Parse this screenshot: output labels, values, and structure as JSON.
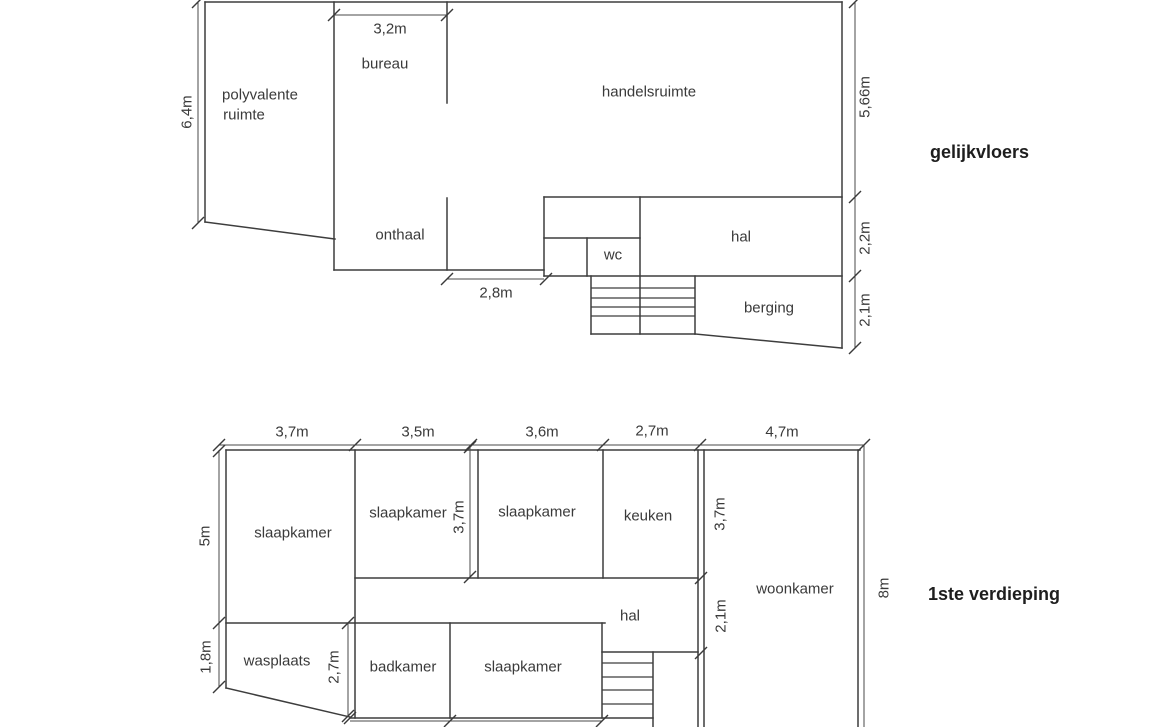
{
  "document": {
    "background": "#ffffff",
    "wall_color": "#3d3d3d",
    "dimension_color": "#4a4a4a",
    "label_color": "#3a3a3a",
    "title_color": "#1e1e1e"
  },
  "plans": [
    {
      "id": "gelijkvloers",
      "title": {
        "text": "gelijkvloers"
      },
      "walls": [
        [
          205,
          2,
          842,
          2
        ],
        [
          205,
          2,
          205,
          222
        ],
        [
          205,
          222,
          335,
          239
        ],
        [
          334,
          2,
          334,
          270
        ],
        [
          334,
          270,
          544,
          270
        ],
        [
          447,
          2,
          447,
          103
        ],
        [
          447,
          198,
          447,
          270
        ],
        [
          842,
          2,
          842,
          348
        ],
        [
          544,
          197,
          842,
          197
        ],
        [
          544,
          197,
          544,
          276
        ],
        [
          544,
          238,
          640,
          238
        ],
        [
          587,
          238,
          587,
          276
        ],
        [
          640,
          197,
          640,
          334
        ],
        [
          544,
          276,
          842,
          276
        ],
        [
          591,
          276,
          591,
          334
        ],
        [
          591,
          334,
          695,
          334
        ],
        [
          695,
          276,
          695,
          334
        ],
        [
          695,
          334,
          842,
          348
        ]
      ],
      "stair_treads": [
        [
          591,
          288,
          695,
          288
        ],
        [
          591,
          298,
          695,
          298
        ],
        [
          591,
          307,
          695,
          307
        ],
        [
          591,
          316,
          695,
          316
        ]
      ],
      "dim_lines": [
        [
          198,
          2,
          198,
          223
        ],
        [
          334,
          15,
          447,
          15
        ],
        [
          447,
          279,
          544,
          279
        ],
        [
          855,
          2,
          855,
          348
        ]
      ],
      "ticks": [
        [
          198,
          2
        ],
        [
          198,
          223
        ],
        [
          334,
          15
        ],
        [
          447,
          15
        ],
        [
          447,
          279
        ],
        [
          546,
          279
        ],
        [
          855,
          2
        ],
        [
          855,
          197
        ],
        [
          855,
          276
        ],
        [
          855,
          348
        ]
      ],
      "dim_labels": [
        {
          "text": "6,4m",
          "x": 187,
          "y": 112,
          "rotated": true
        },
        {
          "text": "3,2m",
          "x": 390,
          "y": 29,
          "rotated": false
        },
        {
          "text": "2,8m",
          "x": 496,
          "y": 293,
          "rotated": false
        },
        {
          "text": "5,66m",
          "x": 865,
          "y": 97,
          "rotated": true
        },
        {
          "text": "2,2m",
          "x": 865,
          "y": 238,
          "rotated": true
        },
        {
          "text": "2,1m",
          "x": 865,
          "y": 310,
          "rotated": true
        }
      ],
      "room_labels": [
        {
          "text": "polyvalente",
          "x": 260,
          "y": 95
        },
        {
          "text": "ruimte",
          "x": 244,
          "y": 115
        },
        {
          "text": "bureau",
          "x": 385,
          "y": 64
        },
        {
          "text": "handelsruimte",
          "x": 649,
          "y": 92
        },
        {
          "text": "onthaal",
          "x": 400,
          "y": 235
        },
        {
          "text": "wc",
          "x": 613,
          "y": 255
        },
        {
          "text": "hal",
          "x": 741,
          "y": 237
        },
        {
          "text": "berging",
          "x": 769,
          "y": 308
        }
      ]
    },
    {
      "id": "eerste-verdieping",
      "title": {
        "text": "1ste verdieping"
      },
      "walls": [
        [
          226,
          450,
          860,
          450
        ],
        [
          226,
          450,
          226,
          688
        ],
        [
          226,
          688,
          350,
          717
        ],
        [
          350,
          718,
          653,
          718
        ],
        [
          355,
          450,
          355,
          718
        ],
        [
          478,
          450,
          478,
          578
        ],
        [
          355,
          578,
          698,
          578
        ],
        [
          603,
          450,
          603,
          578
        ],
        [
          698,
          450,
          698,
          727
        ],
        [
          704,
          450,
          704,
          727
        ],
        [
          226,
          623,
          605,
          623
        ],
        [
          450,
          623,
          450,
          718
        ],
        [
          602,
          623,
          602,
          718
        ],
        [
          602,
          652,
          698,
          652
        ],
        [
          653,
          652,
          653,
          727
        ],
        [
          858,
          450,
          858,
          727
        ]
      ],
      "stair_treads": [
        [
          602,
          663,
          653,
          663
        ],
        [
          602,
          677,
          653,
          677
        ],
        [
          602,
          690,
          653,
          690
        ],
        [
          602,
          704,
          653,
          704
        ]
      ],
      "dim_lines": [
        [
          219,
          445,
          864,
          445
        ],
        [
          219,
          450,
          219,
          687
        ],
        [
          470,
          445,
          470,
          577
        ],
        [
          348,
          623,
          348,
          717
        ],
        [
          864,
          445,
          864,
          727
        ],
        [
          350,
          721,
          602,
          721
        ]
      ],
      "ticks": [
        [
          219,
          445
        ],
        [
          355,
          445
        ],
        [
          471,
          445
        ],
        [
          603,
          445
        ],
        [
          700,
          445
        ],
        [
          864,
          445
        ],
        [
          219,
          451
        ],
        [
          219,
          623
        ],
        [
          219,
          687
        ],
        [
          470,
          447
        ],
        [
          470,
          577
        ],
        [
          348,
          623
        ],
        [
          348,
          716
        ],
        [
          701,
          578
        ],
        [
          701,
          653
        ],
        [
          350,
          718
        ],
        [
          450,
          721
        ],
        [
          602,
          721
        ]
      ],
      "dim_labels": [
        {
          "text": "3,7m",
          "x": 292,
          "y": 432,
          "rotated": false
        },
        {
          "text": "3,5m",
          "x": 418,
          "y": 432,
          "rotated": false
        },
        {
          "text": "3,6m",
          "x": 542,
          "y": 432,
          "rotated": false
        },
        {
          "text": "2,7m",
          "x": 652,
          "y": 431,
          "rotated": false
        },
        {
          "text": "4,7m",
          "x": 782,
          "y": 432,
          "rotated": false
        },
        {
          "text": "5m",
          "x": 205,
          "y": 536,
          "rotated": true
        },
        {
          "text": "1,8m",
          "x": 206,
          "y": 657,
          "rotated": true
        },
        {
          "text": "3,7m",
          "x": 459,
          "y": 517,
          "rotated": true
        },
        {
          "text": "2,7m",
          "x": 334,
          "y": 667,
          "rotated": true
        },
        {
          "text": "3,7m",
          "x": 720,
          "y": 514,
          "rotated": true
        },
        {
          "text": "2,1m",
          "x": 721,
          "y": 616,
          "rotated": true
        },
        {
          "text": "8m",
          "x": 884,
          "y": 588,
          "rotated": true
        }
      ],
      "room_labels": [
        {
          "text": "slaapkamer",
          "x": 293,
          "y": 533
        },
        {
          "text": "slaapkamer",
          "x": 408,
          "y": 513
        },
        {
          "text": "slaapkamer",
          "x": 537,
          "y": 512
        },
        {
          "text": "keuken",
          "x": 648,
          "y": 516
        },
        {
          "text": "woonkamer",
          "x": 795,
          "y": 589
        },
        {
          "text": "hal",
          "x": 630,
          "y": 616
        },
        {
          "text": "wasplaats",
          "x": 277,
          "y": 661
        },
        {
          "text": "badkamer",
          "x": 403,
          "y": 667
        },
        {
          "text": "slaapkamer",
          "x": 523,
          "y": 667
        }
      ]
    }
  ]
}
